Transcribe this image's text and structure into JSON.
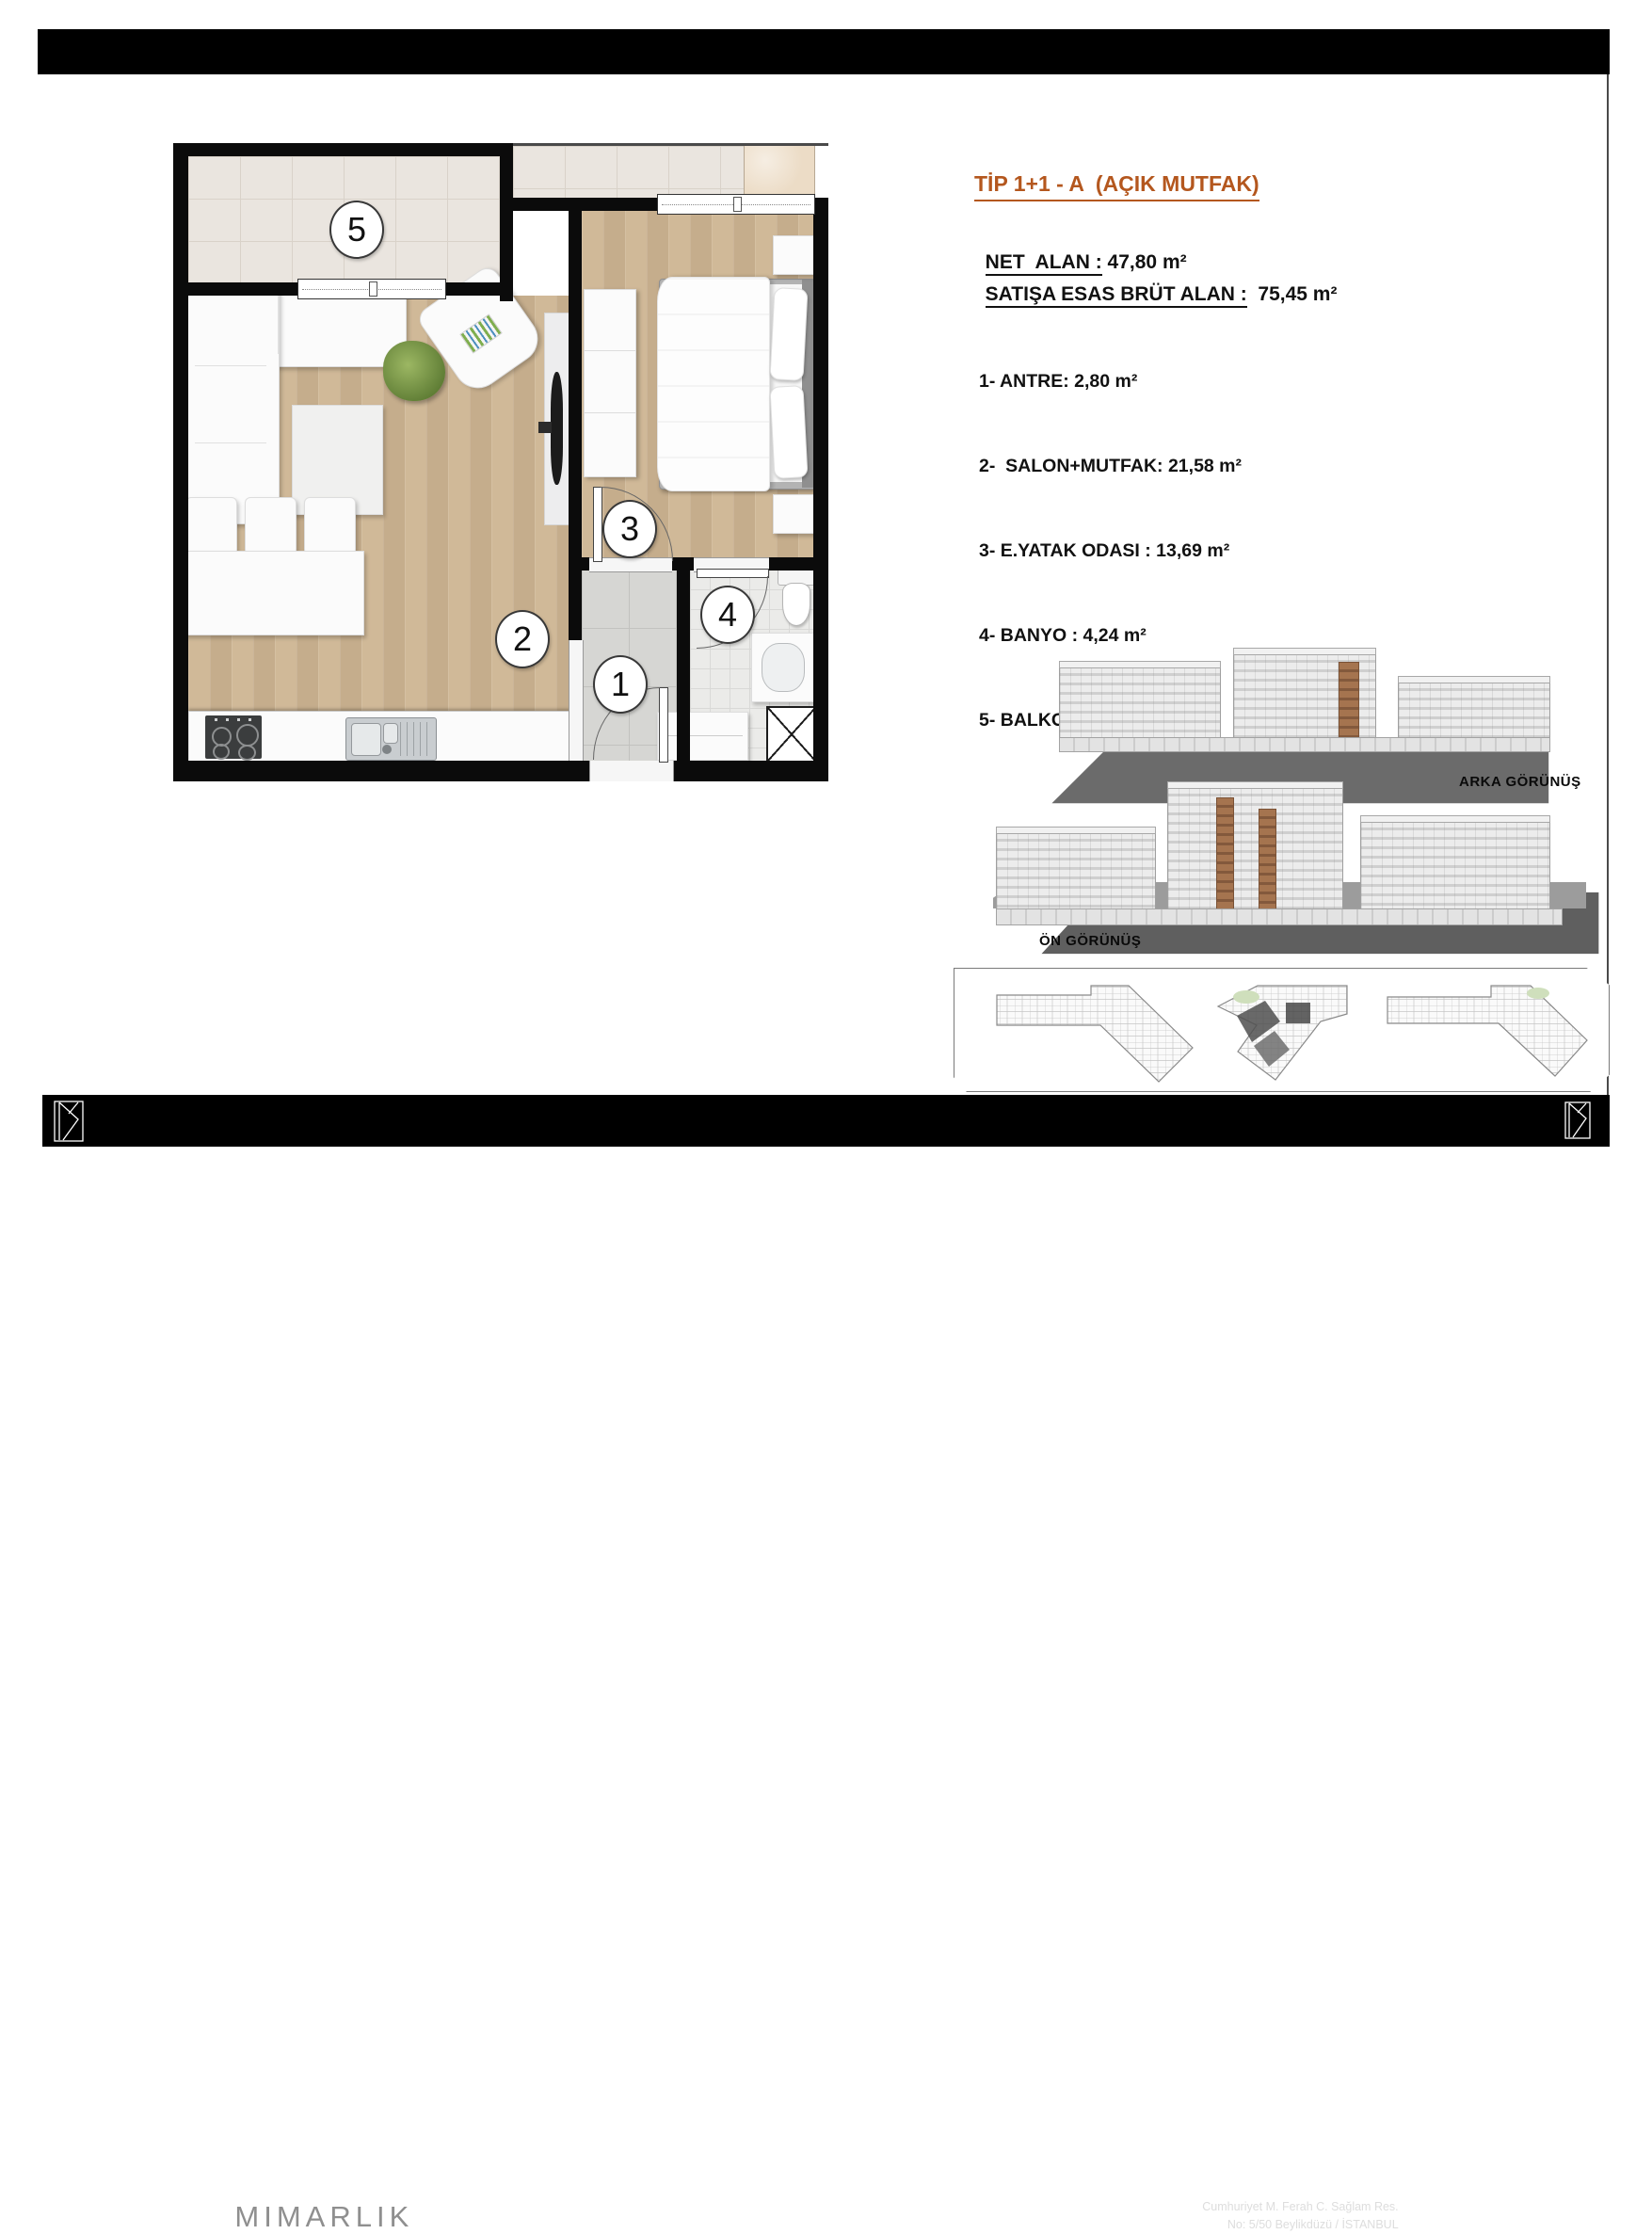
{
  "info": {
    "title": "TİP 1+1 - A  (AÇIK MUTFAK)",
    "net_alan_label": "NET  ALAN :",
    "net_alan_value": " 47,80 m²",
    "brut_label": "SATIŞA ESAS BRÜT ALAN :",
    "brut_value": "  75,45 m²",
    "rooms": [
      "1- ANTRE: 2,80 m²",
      "2-  SALON+MUTFAK: 21,58 m²",
      "3- E.YATAK ODASI : 13,69 m²",
      "4- BANYO : 4,24 m²",
      "5- BALKON : 5,49 m²"
    ]
  },
  "plan": {
    "room_numbers": {
      "n1": "1",
      "n2": "2",
      "n3": "3",
      "n4": "4",
      "n5": "5"
    }
  },
  "elevations": {
    "back_label": "ARKA GÖRÜNÜŞ",
    "front_label": "ÖN GÖRÜNÜŞ"
  },
  "footer": {
    "brand_primary": "KUBA",
    "brand_secondary": "MIMARLIK",
    "address_line1": "Cumhuriyet M. Ferah C. Sağlam Res.",
    "address_line2": "No: 5/50  Beylikdüzü / İSTANBUL",
    "phone_t": "T : 0212 853 50 60",
    "phone_f": "F : 0212 853 13 29"
  },
  "colors": {
    "accent": "#b4571e",
    "wall": "#0b0b0b",
    "wood": "#cdb596",
    "balcony_tile": "#eae5df",
    "entry_tile": "#d6d6d3",
    "bath_tile": "#ebebe9",
    "marble": "#ecdcc6",
    "elevation_brown": "#9c6c4e",
    "ground": "#6b6b6b"
  }
}
